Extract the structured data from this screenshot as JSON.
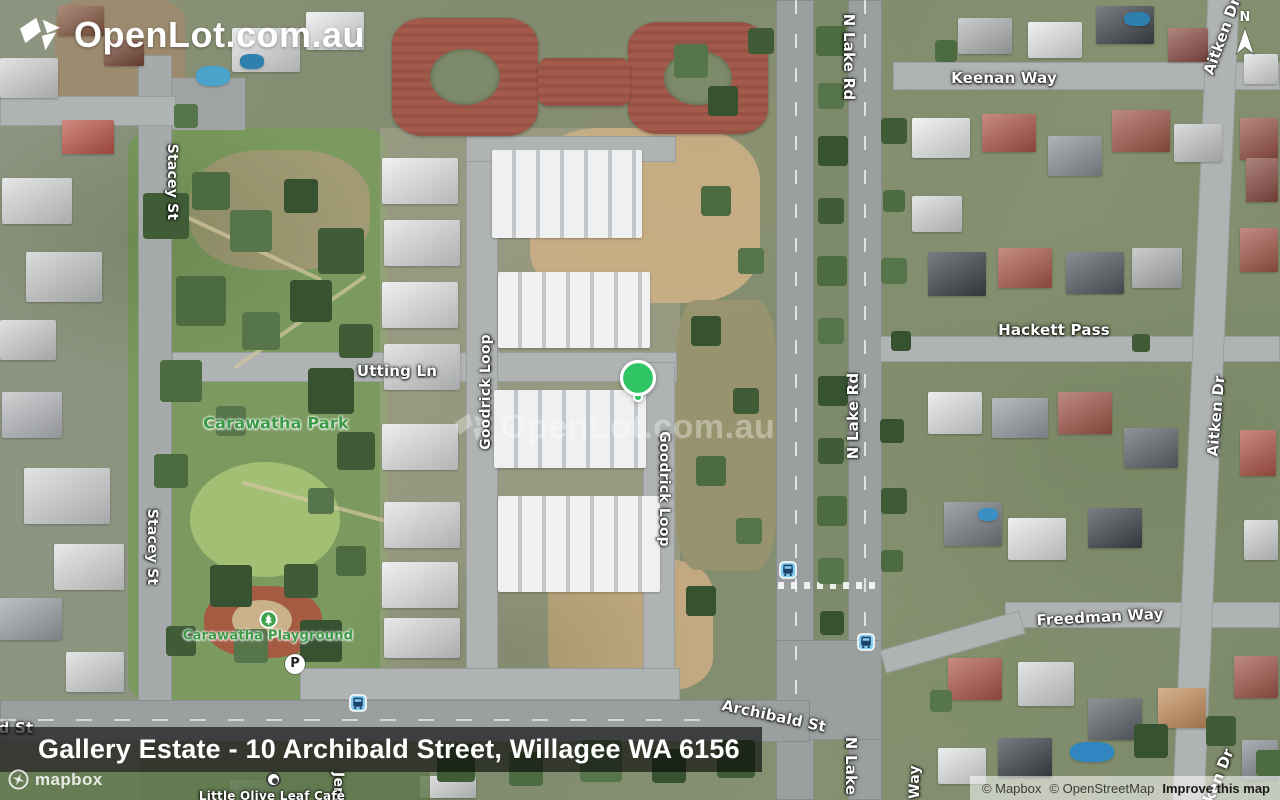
{
  "brand": {
    "logo_text": "OpenLot.com.au",
    "watermark_text": "OpenLot.com.au"
  },
  "compass": {
    "label": "N"
  },
  "title_bar": {
    "text": "Gallery Estate - 10 Archibald Street, Willagee WA 6156"
  },
  "attribution": {
    "mapbox_wordmark": "mapbox",
    "copyright_mapbox": "© Mapbox",
    "copyright_osm": "© OpenStreetMap",
    "improve_link": "Improve this map"
  },
  "marker": {
    "x": 638,
    "y": 378,
    "color": "#2fc565"
  },
  "poi": {
    "parking_label": "P",
    "parking": {
      "x": 295,
      "y": 664
    },
    "playground": {
      "x": 268,
      "y": 619
    },
    "cafe": {
      "x": 273,
      "y": 779
    }
  },
  "transit": {
    "stops": [
      {
        "x": 358,
        "y": 703
      },
      {
        "x": 788,
        "y": 570
      },
      {
        "x": 866,
        "y": 642
      }
    ]
  },
  "street_labels": [
    {
      "text": "Stacey St",
      "x": 172,
      "y": 182,
      "rot": 90
    },
    {
      "text": "Stacey St",
      "x": 152,
      "y": 547,
      "rot": 90
    },
    {
      "text": "Utting Ln",
      "x": 397,
      "y": 371,
      "rot": 0,
      "size": 15
    },
    {
      "text": "Goodrick Loop",
      "x": 486,
      "y": 392,
      "rot": -90
    },
    {
      "text": "Goodrick Loop",
      "x": 664,
      "y": 489,
      "rot": 90
    },
    {
      "text": "N Lake Rd",
      "x": 849,
      "y": 57,
      "rot": 90,
      "size": 15
    },
    {
      "text": "N Lake Rd",
      "x": 853,
      "y": 416,
      "rot": -90,
      "size": 15
    },
    {
      "text": "Keenan Way",
      "x": 1004,
      "y": 78,
      "rot": 0,
      "size": 15
    },
    {
      "text": "Hackett Pass",
      "x": 1054,
      "y": 330,
      "rot": 0,
      "size": 15
    },
    {
      "text": "Aitken Dr",
      "x": 1222,
      "y": 36,
      "rot": -70,
      "size": 15
    },
    {
      "text": "Aitken Dr",
      "x": 1216,
      "y": 416,
      "rot": -85,
      "size": 15
    },
    {
      "text": "Aitken Dr",
      "x": 1214,
      "y": 787,
      "rot": -68,
      "size": 15
    },
    {
      "text": "Freedman Way",
      "x": 1100,
      "y": 617,
      "rot": -3,
      "size": 15
    },
    {
      "text": "Archibald St",
      "x": 774,
      "y": 716,
      "rot": 12,
      "size": 15
    },
    {
      "text": "N Lake",
      "x": 851,
      "y": 766,
      "rot": 90,
      "size": 15
    },
    {
      "text": "Way",
      "x": 915,
      "y": 782,
      "rot": -90
    },
    {
      "text": "Jem",
      "x": 338,
      "y": 787,
      "rot": 90
    },
    {
      "text": "d St",
      "x": 16,
      "y": 728,
      "rot": 0,
      "size": 15
    },
    {
      "text": "Little Olive Leaf Cafe",
      "x": 272,
      "y": 796,
      "rot": 0,
      "size": 12
    },
    {
      "text": "Carawatha Park",
      "x": 276,
      "y": 423,
      "rot": 0,
      "size": 16,
      "kind": "park"
    },
    {
      "text": "Carawatha Playground",
      "x": 268,
      "y": 636,
      "rot": 0,
      "size": 13,
      "kind": "park"
    }
  ]
}
